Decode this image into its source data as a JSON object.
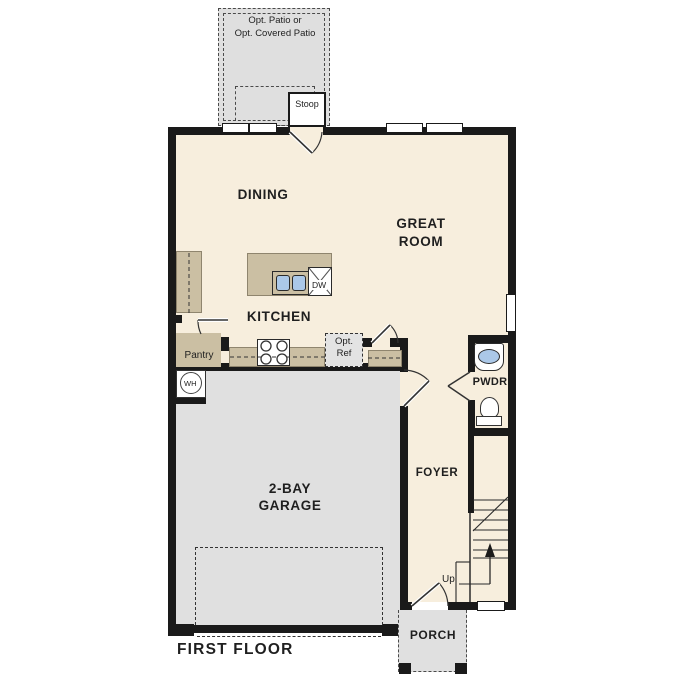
{
  "plan": {
    "title": "FIRST FLOOR"
  },
  "rooms": {
    "dining": "DINING",
    "great_room_1": "GREAT",
    "great_room_2": "ROOM",
    "kitchen": "KITCHEN",
    "garage_1": "2-BAY",
    "garage_2": "GARAGE",
    "foyer": "FOYER",
    "pwdr": "PWDR",
    "porch": "PORCH",
    "pantry": "Pantry",
    "stoop": "Stoop"
  },
  "annotations": {
    "patio_1": "Opt. Patio or",
    "patio_2": "Opt. Covered Patio",
    "opt_ref_1": "Opt.",
    "opt_ref_2": "Ref",
    "dishwasher": "DW",
    "water_heater": "WH",
    "stairs_up": "Up"
  },
  "colors": {
    "wall": "#1a1a1a",
    "interior": "#f7eedd",
    "cabinet": "#cbbfa3",
    "concrete": "#e0e0e0",
    "patio": "#dfdfdf",
    "sink": "#abc8e8",
    "text": "#1f1f1f"
  }
}
